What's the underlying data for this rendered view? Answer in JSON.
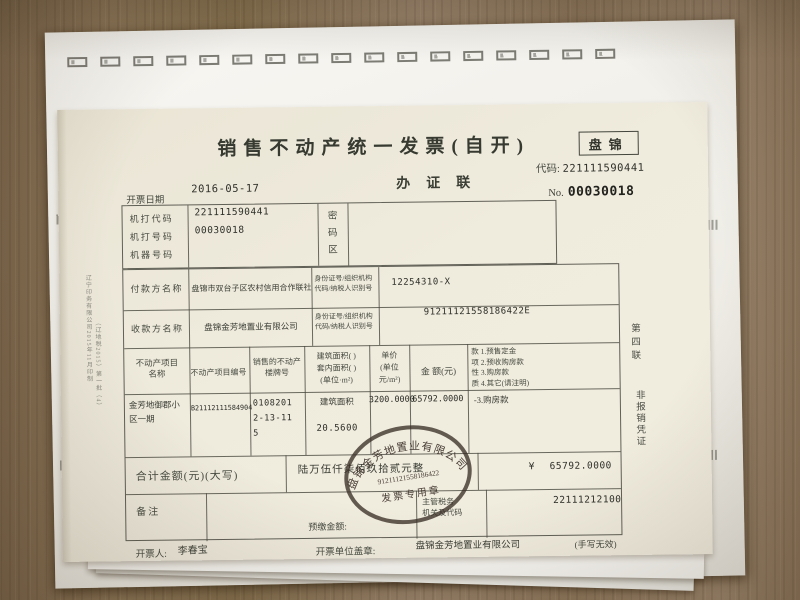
{
  "colors": {
    "paper": "#eee9db",
    "back_paper": "#f6f5f1",
    "ink": "#3f4339",
    "table_line": "#5a5a50",
    "stamp": "#3b322a",
    "wood": "#8c765a"
  },
  "header": {
    "title": "销售不动产统一发票(自开)",
    "region": "盘锦",
    "code_label": "代码:",
    "code_value": "221111590441",
    "copy_name": "办证联",
    "no_label": "No.",
    "no_value": "00030018",
    "date_label": "开票日期",
    "date_value": "2016-05-17"
  },
  "machine": {
    "code_label": "机打代码",
    "code_value": "221111590441",
    "num_label": "机打号码",
    "num_value": "00030018",
    "device_label": "机器号码",
    "device_value": "",
    "password_label": "密\n码\n区"
  },
  "payer": {
    "label": "付款方名称",
    "name": "盘锦市双台子区农村信用合作联社",
    "id_label": "身份证号/组织机构\n代码/纳税人识别号",
    "id_value": "12254310-X"
  },
  "payee": {
    "label": "收款方名称",
    "name": "盘锦金芳地置业有限公司",
    "id_label": "身份证号/组织机构\n代码/纳税人识别号",
    "id_value": "91211121558186422E"
  },
  "items": {
    "headers": {
      "name": "不动产项目\n名称",
      "code": "不动产项目编号",
      "building_no": "销售的不动产\n楼牌号",
      "area": "建筑面积(  )\n套内面积(  )\n(单位·m²)",
      "unit_price": "单价\n(单位\n元/m²)",
      "amount": "金 额(元)",
      "payment_type": "款 1.预售定金\n项 2.预收购房款\n性 3.购房款\n质 4.其它(请注明)"
    },
    "row": {
      "name": "金芳地御郡小区一期",
      "code": "B21112111584904",
      "building_no": "0108201\n2-13-11\n5",
      "area_label": "建筑面积",
      "area_value": "20.5600",
      "unit_price": "3200.0000",
      "amount": "65792.0000",
      "payment_type": "-3.购房款"
    }
  },
  "total": {
    "label": "合计金额(元)(大写)",
    "amount_cn": "陆万伍仟柒佰玖拾贰元整",
    "currency": "¥",
    "amount": "65792.0000"
  },
  "remark": {
    "label": "备注",
    "prepaid_label": "预缴金额:",
    "tax_office_label": "主管税务\n机关及代码",
    "tax_office_code": "22111212100"
  },
  "signoff": {
    "issuer_label": "开票人:",
    "issuer_name": "李春宝",
    "unit_label": "开票单位盖章:",
    "unit_name": "盘锦金芳地置业有限公司",
    "note": "(手写无效)"
  },
  "stamp": {
    "company": "盘锦金芳地置业有限公司",
    "number": "91211121558186422",
    "caption": "发票专用章"
  },
  "margins": {
    "copy_no": "第四联",
    "copy_use": "非报销凭证",
    "print_info_1": "辽宁印务有限公司2015年11月印制",
    "print_info_2": "（辽地税2015）第一批（4）"
  },
  "decor": {
    "top_marks": 17
  }
}
